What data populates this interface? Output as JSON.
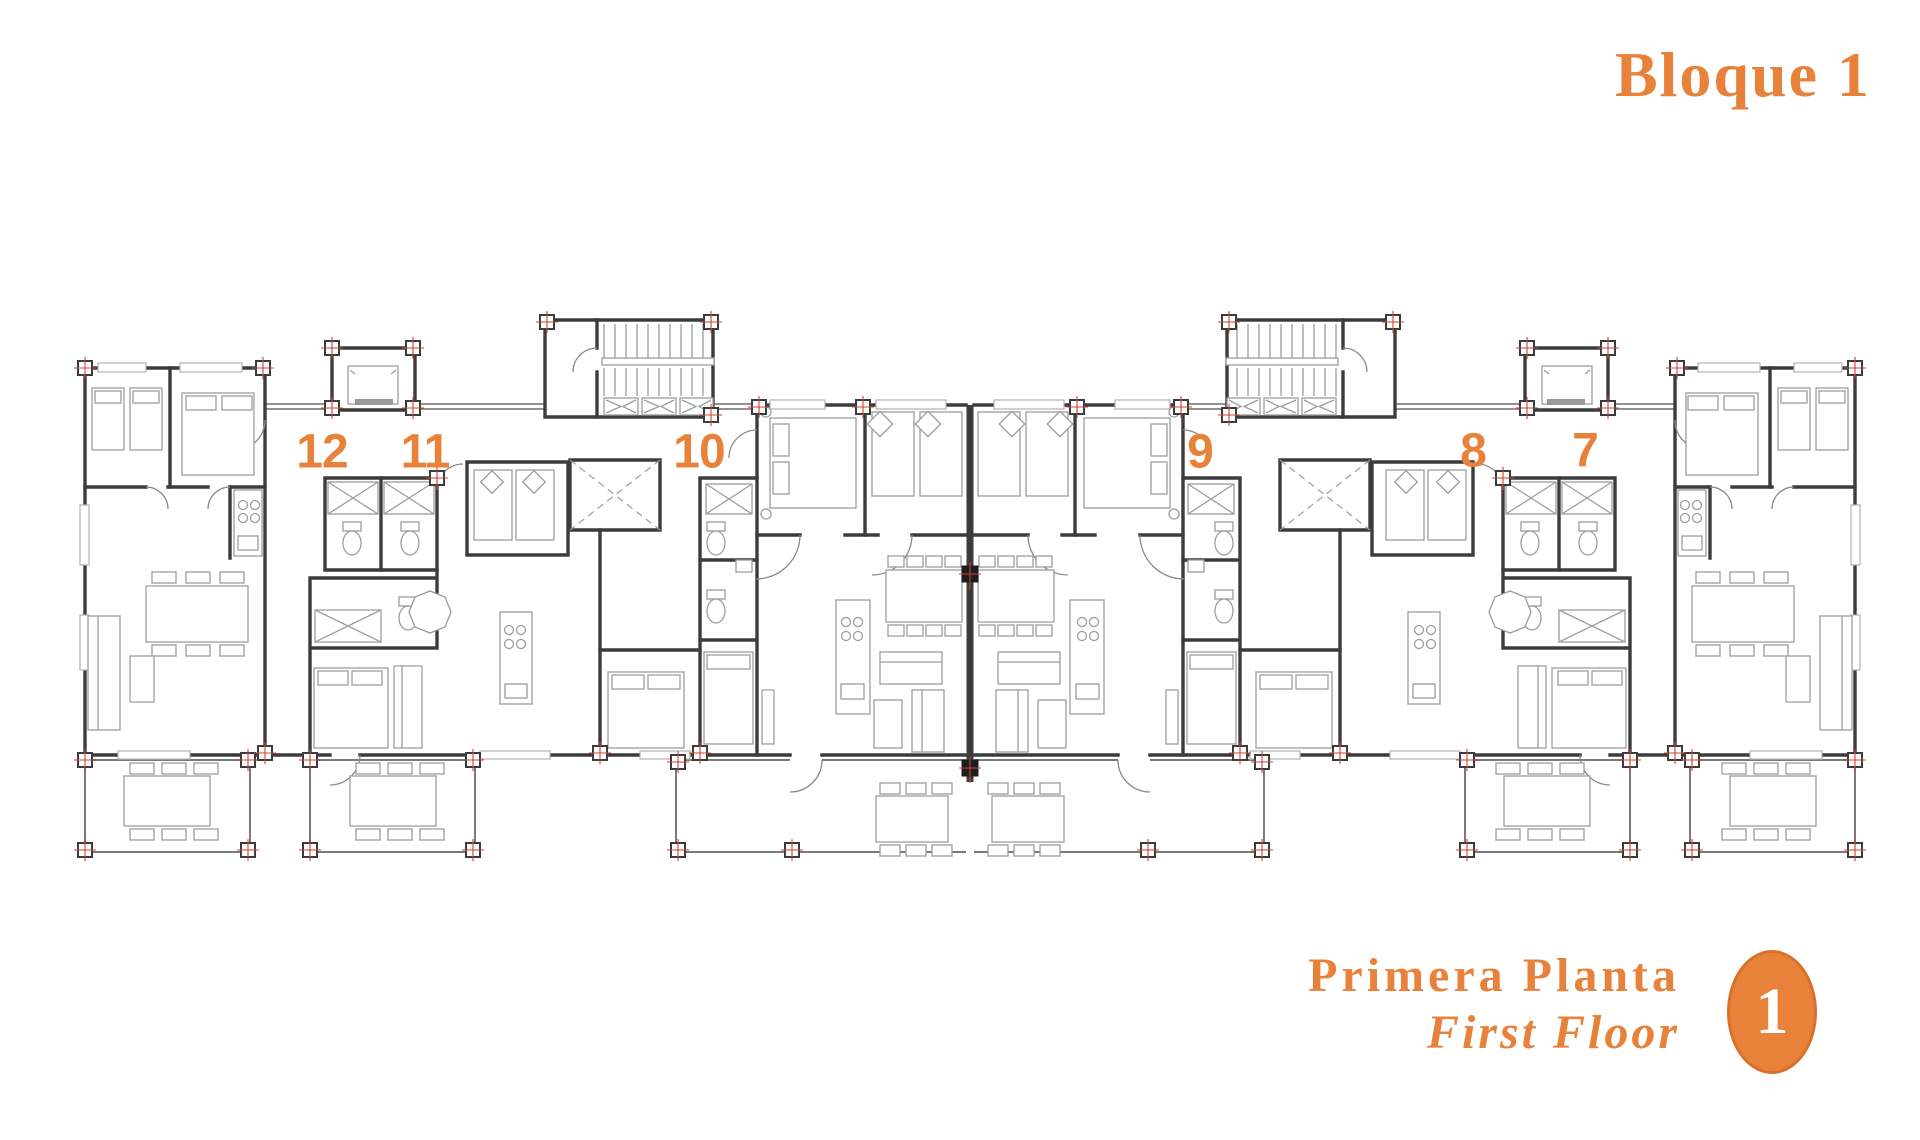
{
  "header": {
    "title": "Bloque 1"
  },
  "footer": {
    "floor_name_es": "Primera Planta",
    "floor_name_en": "First Floor",
    "badge": "1"
  },
  "colors": {
    "accent": "#E8823B",
    "accent_dark": "#D9702A",
    "wall": "#3c3c3c",
    "post_marker": "#c94436"
  },
  "units": [
    {
      "id": "12",
      "x": 322,
      "y": 452
    },
    {
      "id": "11",
      "x": 425,
      "y": 452
    },
    {
      "id": "10",
      "x": 699,
      "y": 452
    },
    {
      "id": "9",
      "x": 1200,
      "y": 452
    },
    {
      "id": "8",
      "x": 1473,
      "y": 451
    },
    {
      "id": "7",
      "x": 1585,
      "y": 451
    }
  ]
}
